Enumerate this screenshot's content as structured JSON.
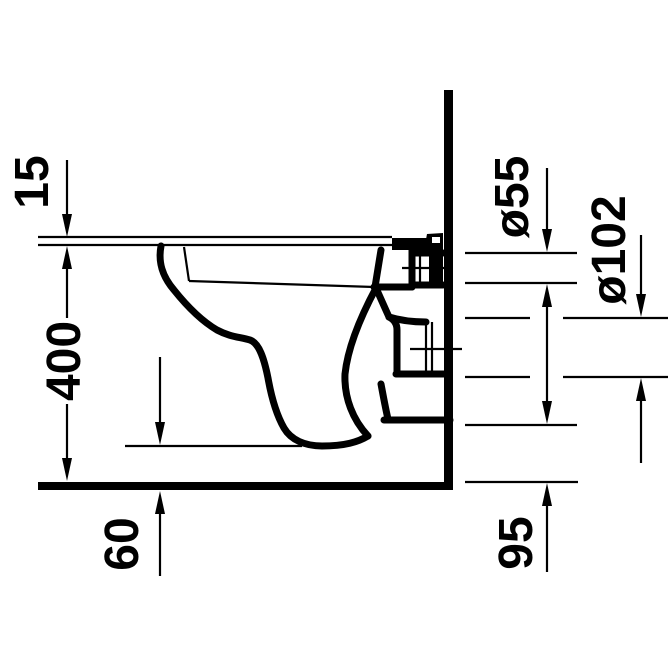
{
  "dimensions": {
    "seat_thickness": "15",
    "bowl_height": "400",
    "underside_clearance": "60",
    "inlet_diameter": "ø55",
    "outlet_diameter": "ø102",
    "outlet_height": "95"
  },
  "colors": {
    "line": "#000000",
    "background": "#ffffff"
  }
}
